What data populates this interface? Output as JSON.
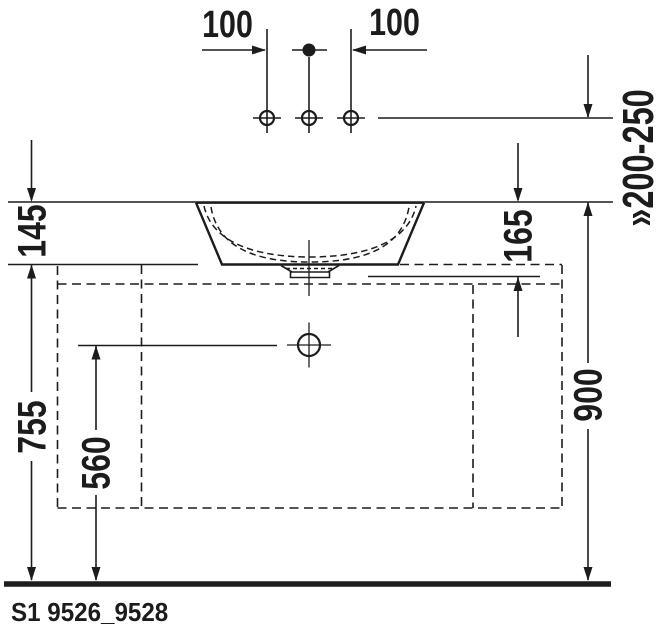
{
  "labels": {
    "hole_offset_left": "100",
    "hole_offset_right": "100",
    "faucet_height_range": "»200-250",
    "bowl_rim_above_counter": "145",
    "bowl_height_total": "165",
    "counter_top_height": "755",
    "outlet_center_height": "560",
    "rim_height_floor": "900",
    "product_code": "S1 9526_9528"
  },
  "colors": {
    "line": "#1c1c1c",
    "background": "#ffffff"
  }
}
